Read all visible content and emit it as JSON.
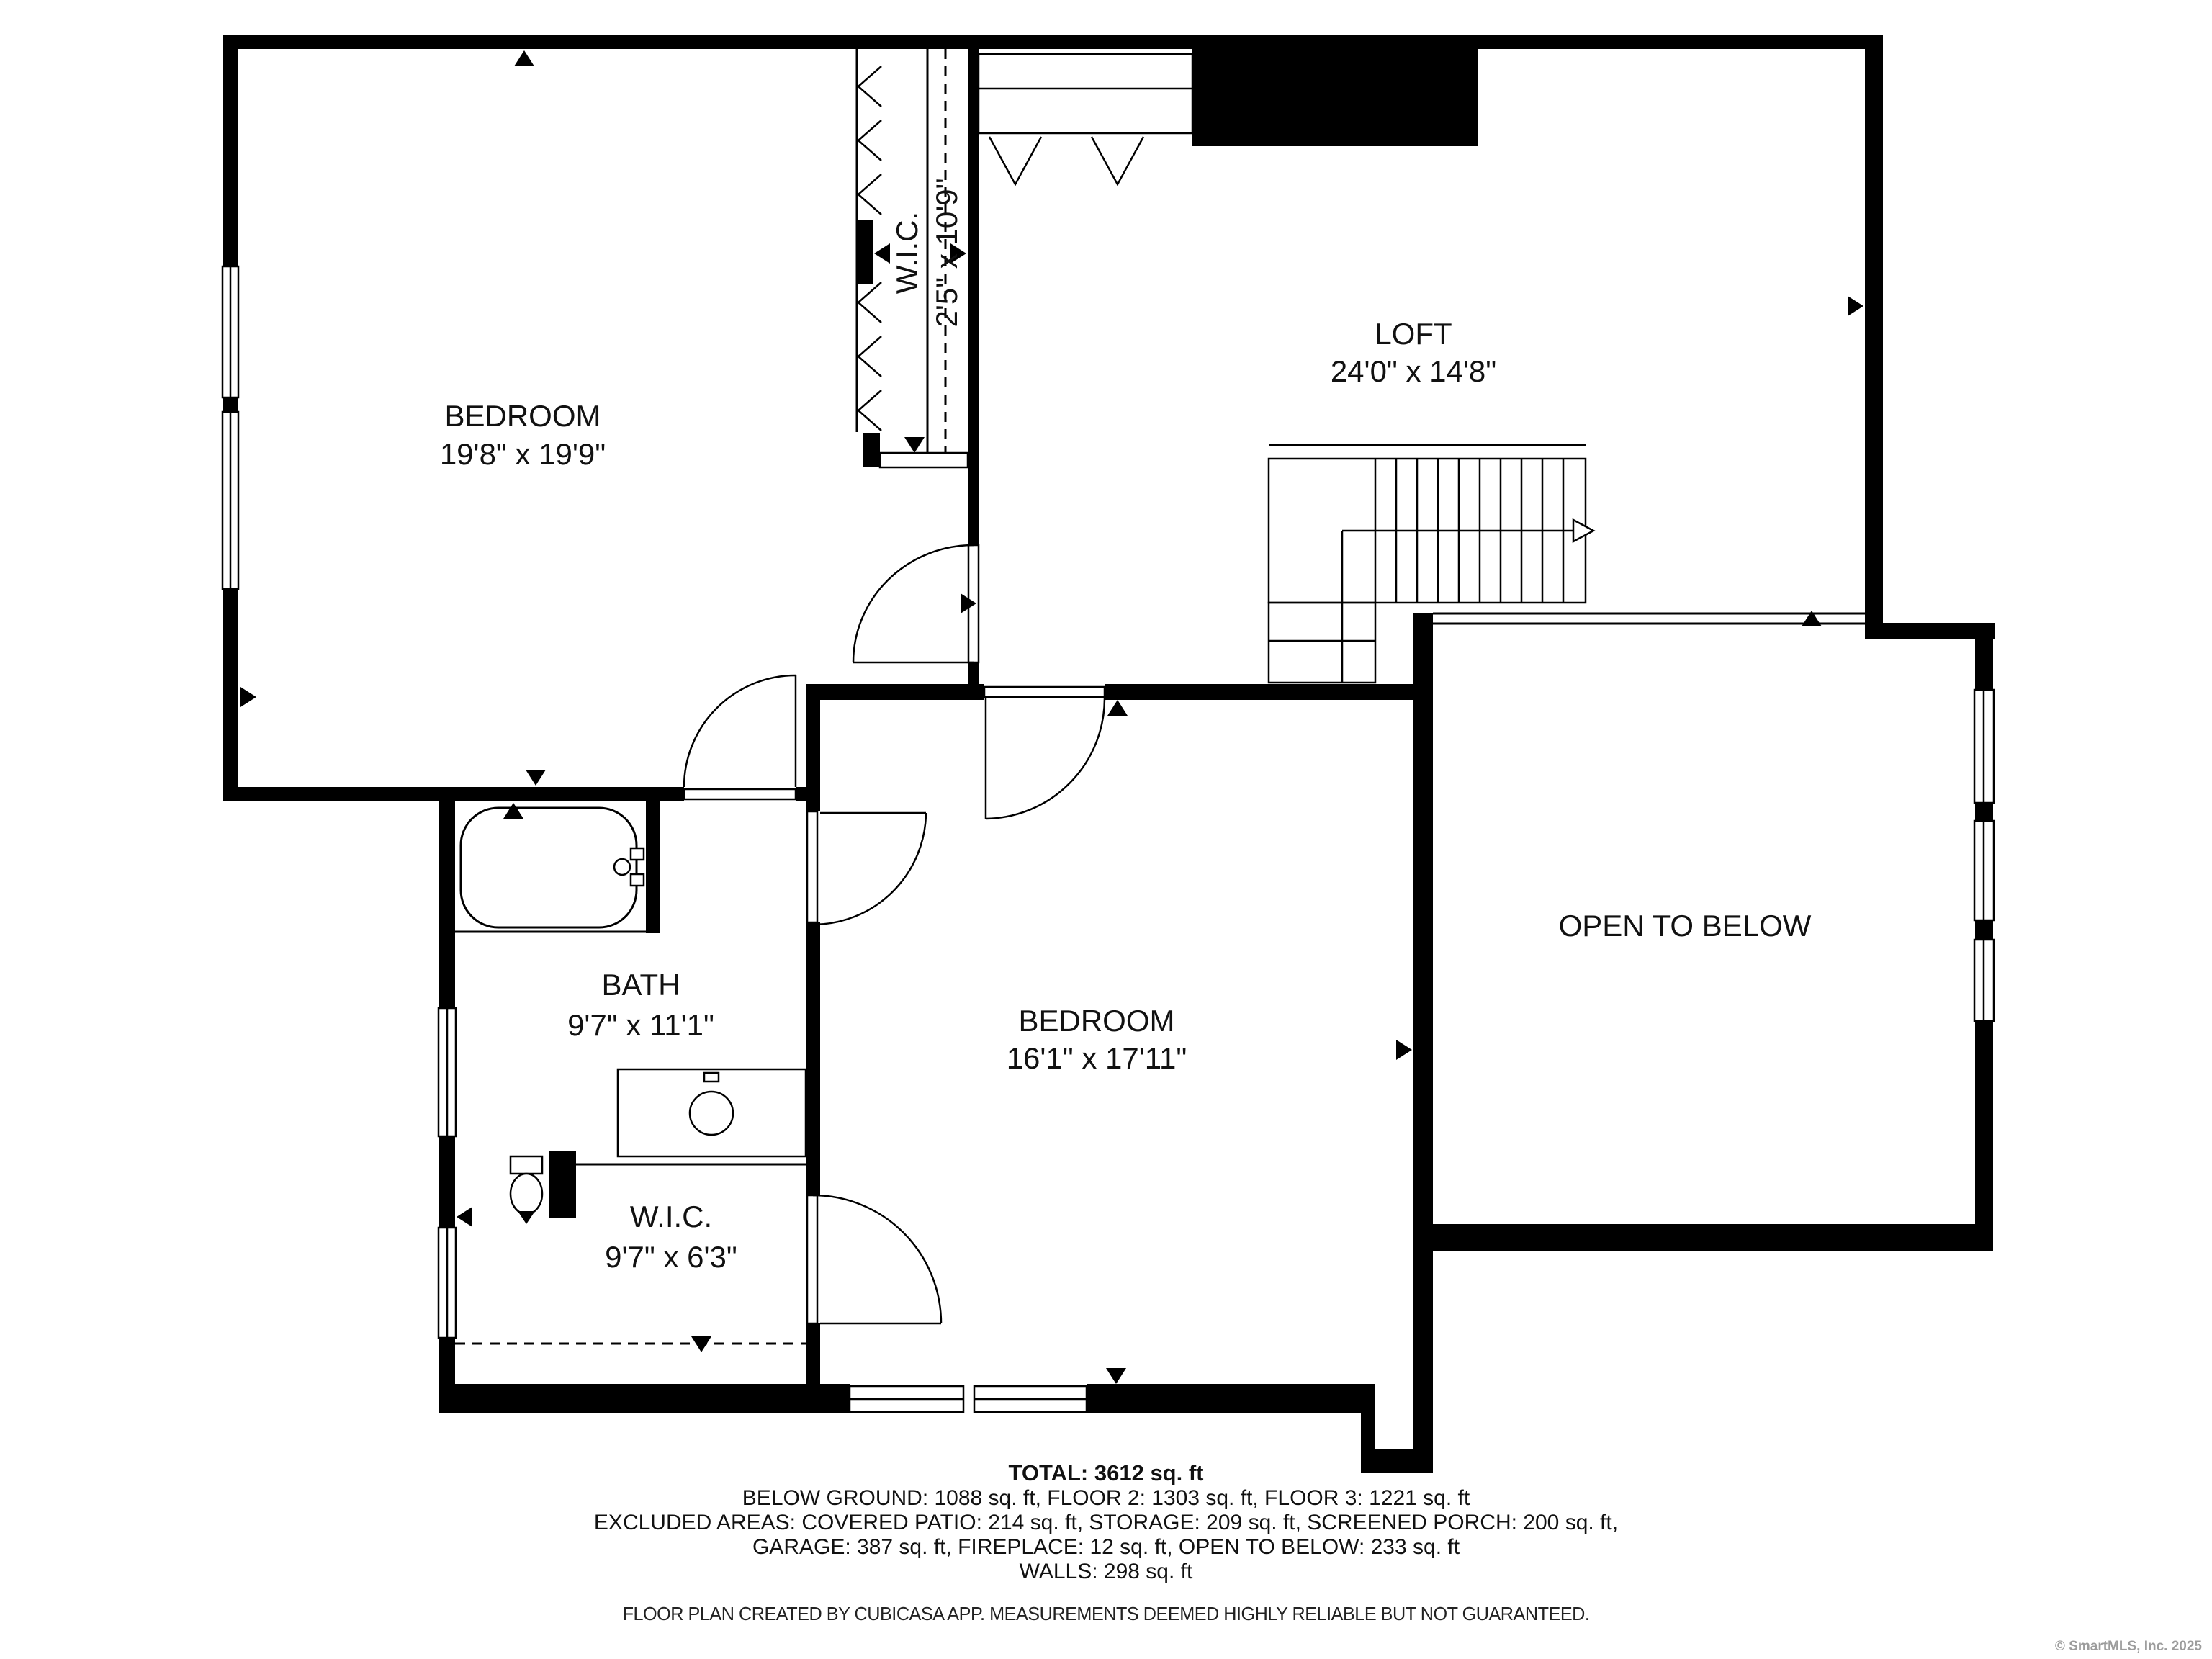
{
  "floor_plan": {
    "rooms": {
      "bedroom1": {
        "name": "BEDROOM",
        "dimensions": "19'8\" x 19'9\""
      },
      "wic1": {
        "name": "W.I.C.",
        "dimensions": "2'5\" x 10'9\""
      },
      "loft": {
        "name": "LOFT",
        "dimensions": "24'0\" x 14'8\""
      },
      "bath": {
        "name": "BATH",
        "dimensions": "9'7\" x 11'1\""
      },
      "bedroom2": {
        "name": "BEDROOM",
        "dimensions": "16'1\" x 17'11\""
      },
      "wic2": {
        "name": "W.I.C.",
        "dimensions": "9'7\" x 6'3\""
      },
      "open_below": {
        "name": "OPEN TO BELOW",
        "dimensions": ""
      }
    },
    "summary": {
      "total": "TOTAL: 3612 sq. ft",
      "line2": "BELOW GROUND: 1088 sq. ft, FLOOR 2: 1303 sq. ft, FLOOR 3: 1221 sq. ft",
      "line3": "EXCLUDED AREAS: COVERED PATIO: 214 sq. ft, STORAGE: 209 sq. ft, SCREENED PORCH: 200 sq. ft,",
      "line4": "GARAGE: 387 sq. ft, FIREPLACE: 12 sq. ft, OPEN TO BELOW: 233 sq. ft",
      "line5": "WALLS: 298 sq. ft"
    },
    "disclaimer": "FLOOR PLAN CREATED BY CUBICASA APP. MEASUREMENTS DEEMED HIGHLY RELIABLE BUT NOT GUARANTEED.",
    "copyright": "© SmartMLS, Inc. 2025",
    "colors": {
      "walls": "#000000",
      "background": "#ffffff",
      "copyright": "#9c9c9c"
    }
  }
}
